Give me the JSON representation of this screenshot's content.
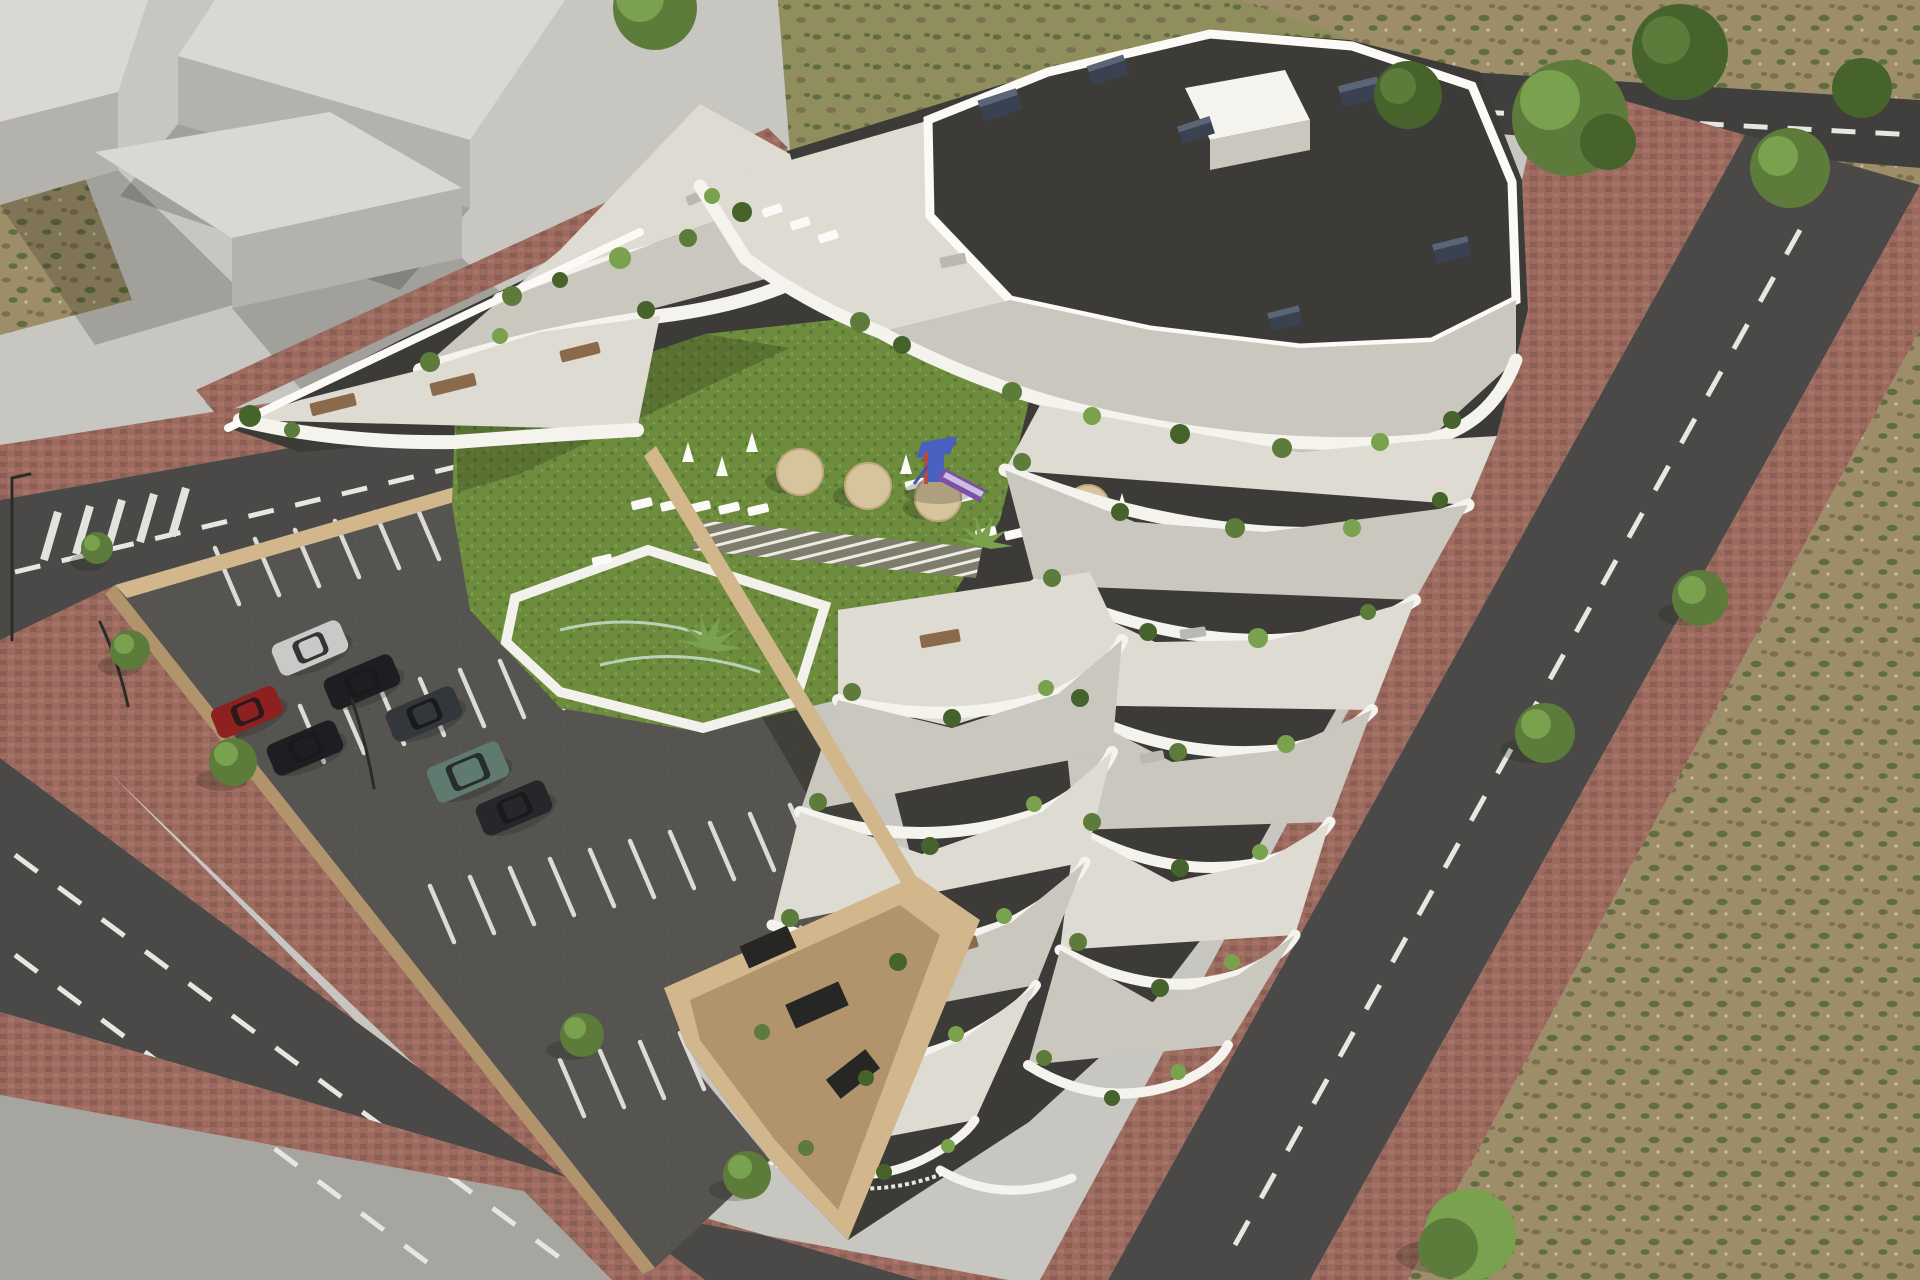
{
  "scene": {
    "type": "architectural-aerial-render",
    "description": "Aerial 3D rendering of a modern white terraced apartment complex with organic curved balconies, a landscaped courtyard with lawn, swimming pool, sun loungers, parasols and a playground, an open-air parking lot with cars, brick-paved sidewalks, asphalt roads with dashed lane markings, plain grey massing blocks of neighbouring buildings on a paved plaza to the upper left, and dry scrubland with trees to the right."
  },
  "building": {
    "style": "organic terraced balconies, stacked white curved bands",
    "roof": "flat gravel roof with dark ventilation boxes",
    "roof_vents": 6,
    "terrace_levels_visible": 8,
    "balcony_plants": "potted shrubs, cypresses and palms",
    "base": "beige retaining walls with dark glazed ground floor"
  },
  "courtyard": {
    "lawn": true,
    "pool": true,
    "pool_shape": "irregular polygon with white rim",
    "wooden_deck_path": true,
    "tan_umbrellas": 4,
    "white_folded_parasols": 6,
    "sun_loungers": 14,
    "playground": {
      "present": true,
      "tower_color": "blue",
      "slide_color": "purple"
    },
    "palms": 2
  },
  "parking": {
    "marked_spaces": true,
    "space_rows": 4,
    "cars": [
      {
        "color_name": "silver"
      },
      {
        "color_name": "black"
      },
      {
        "color_name": "dark-grey"
      },
      {
        "color_name": "red"
      },
      {
        "color_name": "black"
      },
      {
        "color_name": "green-suv"
      },
      {
        "color_name": "dark-sedan"
      }
    ],
    "street_trees": 5,
    "lamp_posts": 3,
    "boundary": "beige retaining walls"
  },
  "roads": {
    "upper_left_road": {
      "dashed_centerline": true,
      "crosswalk": true
    },
    "lower_left_road": {
      "lanes": 2,
      "dashed_lines": 2
    },
    "right_road": {
      "dashed_centerline": true
    },
    "top_right_road": {
      "dashed_centerline": true
    },
    "sidewalks": "reddish brick paving"
  },
  "surroundings": {
    "massing_blocks": 3,
    "plaza": true,
    "scrubland": true,
    "large_trees": 6,
    "dry_grass_strip_top": true,
    "dirt_patch_left": true
  },
  "colors": {
    "plaza": "#c7c6c1",
    "plazaDark": "#a6a5a0",
    "blockTop": "#d9d8d3",
    "blockSide": "#b3b2ac",
    "road": "#4a4947",
    "roadDark": "#403f3d",
    "dash": "#e6e6e3",
    "stripe": "#dcdbd7",
    "sidewalk": "#9c6a5e",
    "sidewalkDot": "#7c544b",
    "sidewalkLight": "#b07f72",
    "parking": "#565450",
    "wallTop": "#d2b68c",
    "wallSide": "#b2946c",
    "darkWall": "#3c3b38",
    "glass": "#262624",
    "white": "#f4f3ee",
    "whiteBright": "#fbfaf7",
    "floorL": "#dedbd3",
    "floorD": "#cac7bf",
    "gravel": "#b4b3ae",
    "gravelDark": "#8e8d89",
    "gravelLight": "#d7d6d2",
    "vent": "#3a4150",
    "ventTop": "#5a6578",
    "lawn": "#6d8c3d",
    "lawnDark": "#57752f",
    "lawnLight": "#7fa04c",
    "pool": "#aadcd6",
    "poolDeep": "#8fcfc8",
    "poolRim": "#f2f1ec",
    "deck": "#7e7c6b",
    "deckGap": "#ecebe4",
    "scrub": "#9d8d68",
    "scrubDark": "#7c7050",
    "scrubGreen": "#5f6d3f",
    "grassTop": "#8f8e5c",
    "dirt": "#6e5a3d",
    "tree": "#5d7c3b",
    "treeDark": "#46632c",
    "treeLight": "#79a14e",
    "trunk": "#6b563d",
    "umbrella": "#d8c49c",
    "woodTable": "#8a6a4a",
    "sofa": "#b9b8b2",
    "playBlue": "#4b61c2",
    "playRed": "#b34a46",
    "playPurple": "#7e4fa8",
    "carRed": "#8e2020",
    "carBlack": "#1e1e22",
    "carSilver": "#c9c9c7",
    "carGrey": "#33363a",
    "carGreen": "#5f7b70",
    "carDark": "#26262b",
    "carGlass": "#191a1c",
    "pole": "#2b2b28",
    "shadowCol": "rgba(28,28,22,0.38)",
    "shadowSoft": "rgba(28,28,22,0.22)"
  }
}
